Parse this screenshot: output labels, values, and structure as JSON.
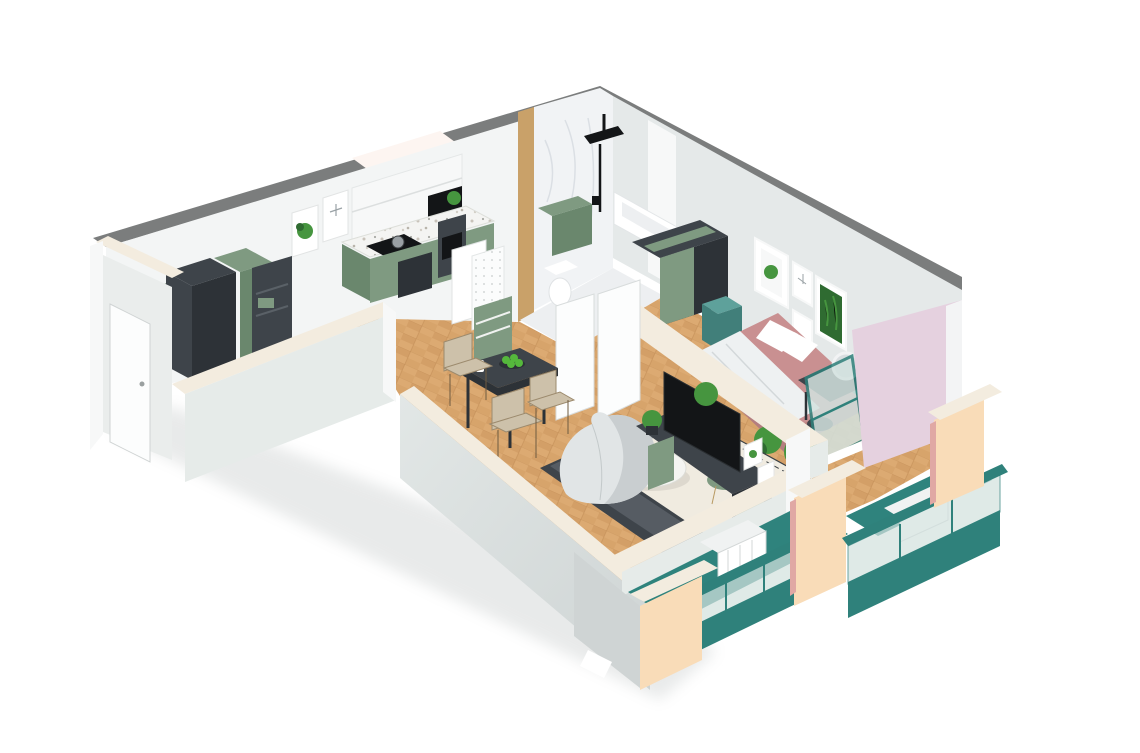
{
  "scene": {
    "description": "3D isometric cutaway render of a one-bedroom apartment floor plan on a white background",
    "style": "isometric-architectural-render",
    "rooms": [
      {
        "name": "entry-hall",
        "furniture": [
          "wardrobe-cabinets",
          "open-shelf",
          "framed-plant-art",
          "framed-dragonfly-art",
          "entry-door"
        ]
      },
      {
        "name": "kitchen",
        "furniture": [
          "upper-cabinets",
          "terrazzo-countertop",
          "cooktop-with-pot",
          "oven-column",
          "fridge",
          "pegboard",
          "storage-cabinet",
          "counter-plant"
        ]
      },
      {
        "name": "bathroom",
        "furniture": [
          "black-shower-set",
          "green-vanity",
          "toilet",
          "bathtub",
          "marble-walls"
        ]
      },
      {
        "name": "hallway",
        "furniture": [
          "open-white-doors",
          "herringbone-parquet"
        ]
      },
      {
        "name": "living-room",
        "furniture": [
          "dining-table",
          "dining-chairs",
          "fruit-bowl",
          "bean-bag",
          "gray-sofa",
          "patterned-rug",
          "round-coffee-table",
          "green-side-table",
          "tv-console",
          "tv",
          "plants",
          "leaning-frames"
        ]
      },
      {
        "name": "bedroom",
        "furniture": [
          "wardrobe",
          "double-bed-pink",
          "teal-nightstand",
          "vanity-desk",
          "round-mirror",
          "stool",
          "plants",
          "teal-balcony-door",
          "framed-plant-art"
        ]
      },
      {
        "name": "balconies",
        "furniture": [
          "teal-glass-railing",
          "white-radiators",
          "cream-parapet-pillars",
          "teal-floor"
        ]
      }
    ]
  },
  "palette": {
    "bg": "#ffffff",
    "capDark": "#7b7d7d",
    "wallWhite": "#f3f5f5",
    "wallGray": "#e5e9e9",
    "wallPale": "#e6ebe9",
    "tipFace": "#eaedec",
    "cutCap": "#f3ecdf",
    "warmWhite": "#fdf5f1",
    "doorWhite": "#fcfdfd",
    "offWhite": "#f7f8f8",
    "marble": "#f1f3f5",
    "marbleFloor": "#edeff1",
    "marbleVein": "#d6dbe1",
    "tan": "#c9a169",
    "teal": "#2f817b",
    "tealDark": "#256b66",
    "tealFloor": "#2f837d",
    "tealBox": "#5ea19b",
    "tealBoxDark": "#417f7a",
    "glass": "#d3e2df",
    "creamWall": "#f9dcb8",
    "creamShade": "#f0cb9e",
    "pinkWall": "#e5d1df",
    "pinkSliver": "#e0a8a4",
    "pinkTrim": "#f3f4f5",
    "woodBase": "#dcaa72",
    "woodDark": "#c99258",
    "woodLine": "#b9854e",
    "green": "#7f9a81",
    "greenDeep": "#6a876d",
    "charcoal": "#3e444a",
    "charcoalDark": "#2d3237",
    "black": "#131517",
    "white": "#ffffff",
    "bedPink": "#c99091",
    "bedPinkDark": "#b47e7f",
    "blanket": "#eef1f2",
    "beige": "#cdc1aa",
    "rugBase": "#f0ebe0",
    "rugBorder": "#3a4045",
    "beanbag": "#e1e5e6",
    "beanbagShade": "#c9ced0",
    "plantGreen": "#46953f",
    "plantDark": "#2f6b31",
    "apple": "#55b83c",
    "radiator": "#f0f2f2",
    "shadowCol": "#c5c9c9",
    "grayDecor": "#9aa2a6",
    "wallFaceTop": "#e2e7e6",
    "wallFaceBot": "#ced4d4"
  }
}
